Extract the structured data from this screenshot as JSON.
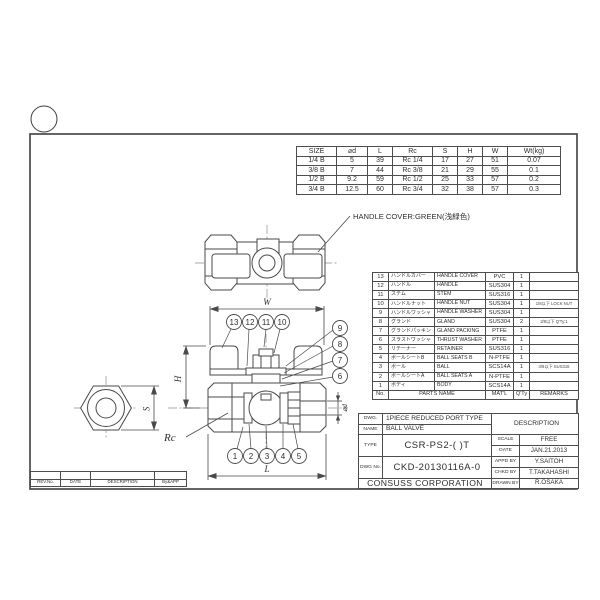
{
  "sheet": {
    "handle_cover_note": "HANDLE COVER:GREEN(浅緑色)"
  },
  "dims": {
    "w": "W",
    "h": "H",
    "l": "L",
    "s": "S",
    "rc": "Rc",
    "d": "⌀d"
  },
  "balloons": [
    "1",
    "2",
    "3",
    "4",
    "5",
    "6",
    "7",
    "8",
    "9",
    "10",
    "11",
    "12",
    "13"
  ],
  "size_table": {
    "headers": [
      "SIZE",
      "⌀d",
      "L",
      "Rc",
      "S",
      "H",
      "W",
      "Wt(kg)"
    ],
    "rows": [
      {
        "size": "1/4 B",
        "d": "5",
        "l": "39",
        "rc": "Rc 1/4",
        "s": "17",
        "h": "27",
        "w": "51",
        "wt": "0.07"
      },
      {
        "size": "3/8 B",
        "d": "7",
        "l": "44",
        "rc": "Rc 3/8",
        "s": "21",
        "h": "29",
        "w": "55",
        "wt": "0.1"
      },
      {
        "size": "1/2 B",
        "d": "9.2",
        "l": "59",
        "rc": "Rc 1/2",
        "s": "25",
        "h": "33",
        "w": "57",
        "wt": "0.2"
      },
      {
        "size": "3/4 B",
        "d": "12.5",
        "l": "60",
        "rc": "Rc 3/4",
        "s": "32",
        "h": "38",
        "w": "57",
        "wt": "0.3"
      }
    ]
  },
  "bom": {
    "header": {
      "no": "No.",
      "parts": "PARTS NAME",
      "matl": "MAT'L",
      "qty": "Q'Ty",
      "remarks": "REMARKS"
    },
    "rows": [
      {
        "no": "13",
        "jp": "ハンドルカバー",
        "en": "HANDLE COVER",
        "matl": "PVC",
        "qty": "1",
        "remarks": ""
      },
      {
        "no": "12",
        "jp": "ハンドル",
        "en": "HANDLE",
        "matl": "SUS304",
        "qty": "1",
        "remarks": ""
      },
      {
        "no": "11",
        "jp": "ステム",
        "en": "STEM",
        "matl": "SUS316",
        "qty": "1",
        "remarks": ""
      },
      {
        "no": "10",
        "jp": "ハンドルナット",
        "en": "HANDLE NUT",
        "matl": "SUS304",
        "qty": "1",
        "remarks": "1/8以下 LOCK NUT"
      },
      {
        "no": "9",
        "jp": "ハンドルワッシャ",
        "en": "HANDLE WASHER",
        "matl": "SUS304",
        "qty": "1",
        "remarks": ""
      },
      {
        "no": "8",
        "jp": "グランド",
        "en": "GLAND",
        "matl": "SUS304",
        "qty": "2",
        "remarks": "3/8以下 Q'Ty:1"
      },
      {
        "no": "7",
        "jp": "グランドパッキン",
        "en": "GLAND PACKING",
        "matl": "PTFE",
        "qty": "1",
        "remarks": ""
      },
      {
        "no": "6",
        "jp": "スラストワッシャ",
        "en": "THRUST WASHER",
        "matl": "PTFE",
        "qty": "1",
        "remarks": ""
      },
      {
        "no": "5",
        "jp": "リテーナー",
        "en": "RETAINER",
        "matl": "SUS316",
        "qty": "1",
        "remarks": ""
      },
      {
        "no": "4",
        "jp": "ボールシートB",
        "en": "BALL SEATS B",
        "matl": "N-PTFE",
        "qty": "1",
        "remarks": ""
      },
      {
        "no": "3",
        "jp": "ボール",
        "en": "BALL",
        "matl": "SCS14A",
        "qty": "1",
        "remarks": "3/8以下 SUS316"
      },
      {
        "no": "2",
        "jp": "ボールシートA",
        "en": "BALL SEATS A",
        "matl": "N-PTFE",
        "qty": "1",
        "remarks": ""
      },
      {
        "no": "1",
        "jp": "ボディ",
        "en": "BODY",
        "matl": "SCS14A",
        "qty": "1",
        "remarks": ""
      }
    ]
  },
  "title_block": {
    "dwg_label": "DWG.",
    "dwg_value": "1PIECE REDUCED PORT TYPE",
    "description_label": "DESCRIPTION",
    "name_label": "NAME",
    "name_value": "BALL VALVE",
    "type_label": "TYPE",
    "type_value": "CSR-PS2-( )T",
    "scale_label": "SCALE",
    "scale_value": "FREE",
    "date_label": "DATE",
    "date_value": "JAN.21.2013",
    "dwg_no_label": "DWG No.",
    "dwg_no_value": "CKD-20130116A-0",
    "appd_label": "APPD BY",
    "appd_value": "Y.SAITOH",
    "chkd_label": "CHKD BY",
    "chkd_value": "T.TAKAHASHI",
    "drawn_label": "DRAWN BY",
    "drawn_value": "R.OSAKA",
    "company": "CONSUSS CORPORATION"
  },
  "revision_table": {
    "headers": [
      "REV.No.",
      "DATE",
      "DESCRIPTION",
      "By&APP"
    ]
  }
}
